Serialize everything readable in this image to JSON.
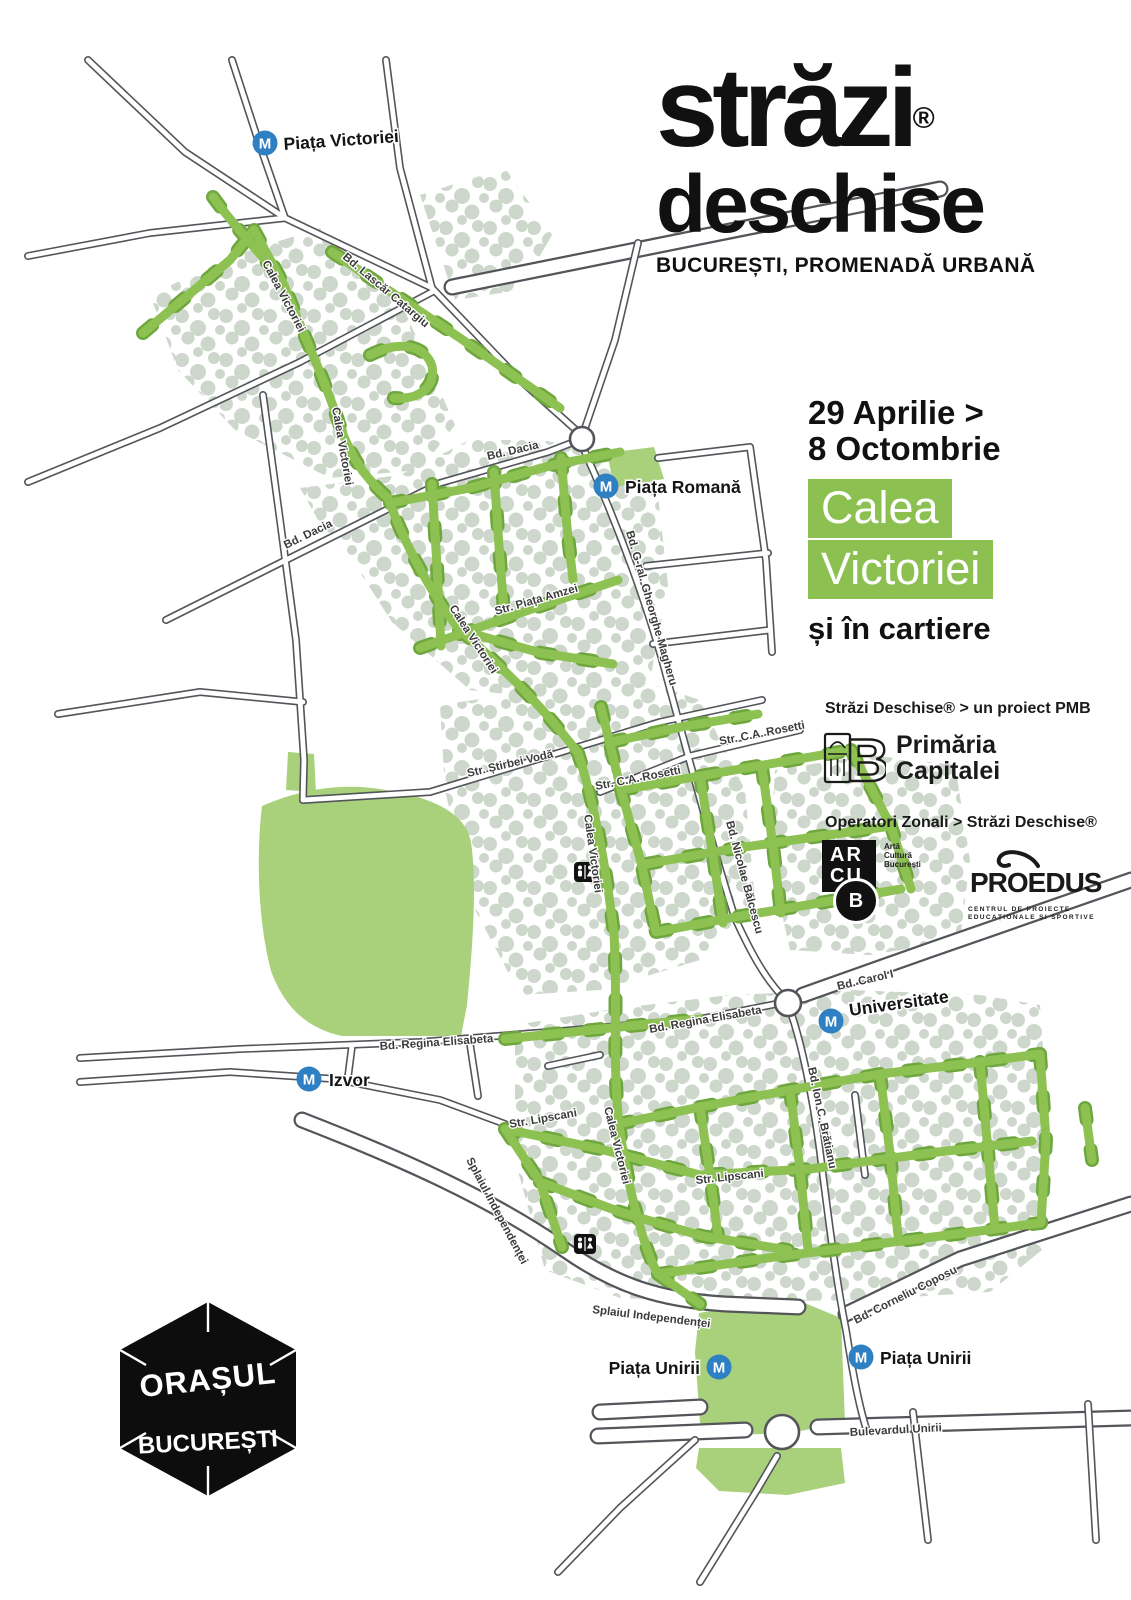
{
  "title": {
    "wordmark": "străzi",
    "registered": "®",
    "wordmark2": "deschise",
    "subtitle": "BUCUREȘTI, PROMENADĂ URBANĂ"
  },
  "event": {
    "date_line1": "29 Aprilie >",
    "date_line2": "8 Octombrie",
    "highlight_line1": "Calea",
    "highlight_line2": "Victoriei",
    "tagline": "și în cartiere"
  },
  "partners": {
    "pmb_caption": "Străzi Deschise® > un proiect PMB",
    "pmb_name_line1": "Primăria",
    "pmb_name_line2": "Capitalei",
    "operators_caption": "Operatori Zonali > Străzi Deschise®",
    "arcub": {
      "row1": "AR",
      "row2": "CU",
      "badge": "B",
      "side_line1": "Artă",
      "side_line2": "Cultură",
      "side_line3": "București"
    },
    "proedus": {
      "name": "PROEDUS",
      "caption_line1": "CENTRUL DE PROIECTE",
      "caption_line2": "EDUCAȚIONALE ȘI SPORTIVE"
    }
  },
  "footer_logo": {
    "line1": "ORAȘUL",
    "line2": "BUCUREȘTI"
  },
  "map": {
    "metro_letter": "M",
    "stations": [
      "Piața Victoriei",
      "Piața Romană",
      "Universitate",
      "Izvor",
      "Piața Unirii",
      "Piața Unirii"
    ],
    "street_labels": [
      "Bd. Lascăr Catargiu",
      "Calea Victoriei",
      "Calea Victoriei",
      "Bd. Dacia",
      "Bd. Dacia",
      "Str. Piața Amzei",
      "Bd. G-ral. Gheorghe Magheru",
      "Calea Victoriei",
      "Str. Știrbei Vodă",
      "Str. C.A. Rosetti",
      "Str. C.A. Rosetti",
      "Calea Victoriei",
      "Bd. Nicolae Bălcescu",
      "Bd. Carol I",
      "Bd. Regina Elisabeta",
      "Bd. Regina Elisabeta",
      "Bd. Ion C. Brătianu",
      "Str. Lipscani",
      "Str. Lipscani",
      "Calea Victoriei",
      "Splaiul Independenței",
      "Splaiul Independenței",
      "Bd. Corneliu Coposu",
      "Bulevardul Unirii"
    ],
    "colors": {
      "street_green": "#8dc152",
      "street_green_dark": "#6fa73f",
      "park_green": "#a9d17c",
      "dotted_area": "#cdd7cb",
      "road_gray": "#54555a",
      "metro_blue": "#2f80c3",
      "highlight_green": "#8cc152"
    }
  }
}
